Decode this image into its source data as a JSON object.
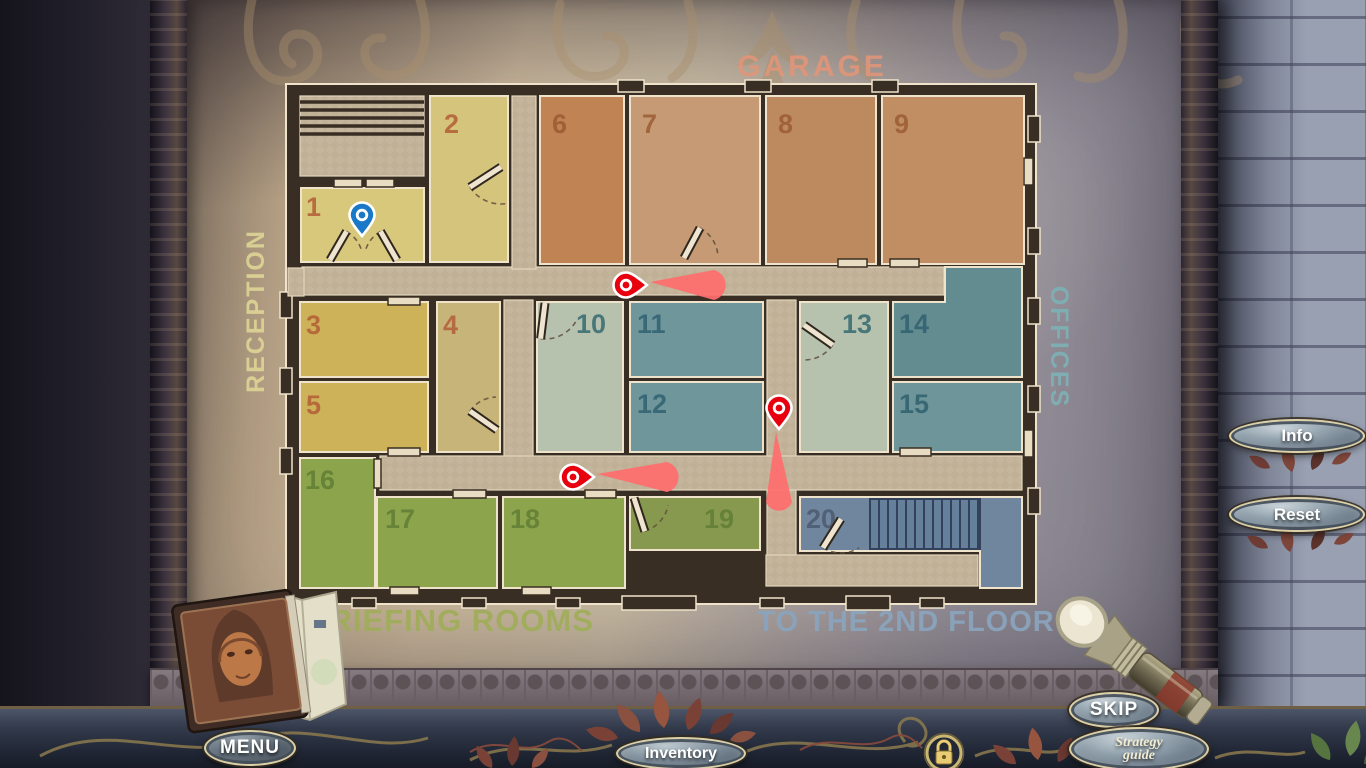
{
  "hud": {
    "info": "Info",
    "reset": "Reset",
    "skip": "SKIP",
    "strategy_line1": "Strategy",
    "strategy_line2": "guide",
    "menu": "MENU",
    "inventory": "Inventory"
  },
  "map": {
    "palette": {
      "wall": "#382e23",
      "outline": "#efe3cb",
      "corridor": "#c4b59c",
      "corridor_check": "#bbab92",
      "beam": "#ff6e6e",
      "pin_red": "#e8000f",
      "pin_blue": "#1a78c8",
      "stair_fill": "#64809b",
      "stair_line": "#33415a"
    },
    "building": {
      "x": 286,
      "y": 84,
      "w": 750,
      "h": 520
    },
    "labels": [
      {
        "id": "garage",
        "text": "GARAGE",
        "x": 812,
        "y": 76,
        "rot": 0,
        "size": 30,
        "color": "#e09579",
        "spacing": 3
      },
      {
        "id": "reception",
        "text": "RECEPTION",
        "x": 264,
        "y": 311,
        "rot": -90,
        "size": 25,
        "color": "#ddd494",
        "spacing": 2
      },
      {
        "id": "offices",
        "text": "OFFICES",
        "x": 1051,
        "y": 347,
        "rot": 90,
        "size": 25,
        "color": "#7db1b5",
        "spacing": 2
      },
      {
        "id": "briefing-rooms",
        "text": "BRIEFING ROOMS",
        "x": 450,
        "y": 631,
        "rot": 0,
        "size": 31,
        "color": "#9fae59",
        "spacing": 1
      },
      {
        "id": "to-the-2nd-floor",
        "text": "TO THE 2ND FLOOR",
        "x": 906,
        "y": 631,
        "rot": 0,
        "size": 29,
        "color": "#8aa5be",
        "spacing": 1
      }
    ],
    "rooms": [
      {
        "n": "1",
        "x": 301,
        "y": 188,
        "w": 123,
        "h": 74,
        "fill": "#d8c87c",
        "nc": "#b25a33",
        "nx": 306,
        "ny": 216
      },
      {
        "n": "2",
        "x": 430,
        "y": 96,
        "w": 78,
        "h": 166,
        "fill": "#d5c57c",
        "nc": "#b25a33",
        "nx": 444,
        "ny": 133
      },
      {
        "n": "3",
        "x": 300,
        "y": 302,
        "w": 128,
        "h": 75,
        "fill": "#cdb259",
        "nc": "#b25a33",
        "nx": 306,
        "ny": 334
      },
      {
        "n": "4",
        "x": 437,
        "y": 302,
        "w": 63,
        "h": 150,
        "fill": "#c7b478",
        "nc": "#b25a33",
        "nx": 443,
        "ny": 334
      },
      {
        "n": "5",
        "x": 300,
        "y": 382,
        "w": 128,
        "h": 70,
        "fill": "#cdb259",
        "nc": "#b25a33",
        "nx": 306,
        "ny": 414
      },
      {
        "n": "6",
        "x": 540,
        "y": 96,
        "w": 84,
        "h": 168,
        "fill": "#bf8354",
        "nc": "#9a5a31",
        "nx": 552,
        "ny": 133
      },
      {
        "n": "7",
        "x": 630,
        "y": 96,
        "w": 130,
        "h": 168,
        "fill": "#c69a74",
        "nc": "#9a5a31",
        "nx": 642,
        "ny": 133
      },
      {
        "n": "8",
        "x": 766,
        "y": 96,
        "w": 110,
        "h": 168,
        "fill": "#bd895f",
        "nc": "#9a5a31",
        "nx": 778,
        "ny": 133
      },
      {
        "n": "9",
        "x": 882,
        "y": 96,
        "w": 142,
        "h": 168,
        "fill": "#c18e64",
        "nc": "#9a5a31",
        "nx": 894,
        "ny": 133
      },
      {
        "n": "10",
        "x": 537,
        "y": 302,
        "w": 86,
        "h": 150,
        "fill": "#b6c2ae",
        "nc": "#31676f",
        "nx": 576,
        "ny": 333
      },
      {
        "n": "11",
        "x": 630,
        "y": 302,
        "w": 133,
        "h": 75,
        "fill": "#6f979b",
        "nc": "#2e5f6e",
        "nx": 637,
        "ny": 333
      },
      {
        "n": "12",
        "x": 630,
        "y": 382,
        "w": 133,
        "h": 70,
        "fill": "#6f979b",
        "nc": "#2e5f6e",
        "nx": 637,
        "ny": 413
      },
      {
        "n": "13",
        "x": 800,
        "y": 302,
        "w": 88,
        "h": 150,
        "fill": "#b6c2ae",
        "nc": "#31676f",
        "nx": 842,
        "ny": 333
      },
      {
        "n": "14",
        "poly": "945,267 1022,267 1022,377 893,377 893,302 945,302",
        "fill": "#638c91",
        "nc": "#2e5f6e",
        "nx": 899,
        "ny": 333
      },
      {
        "n": "15",
        "x": 893,
        "y": 382,
        "w": 129,
        "h": 70,
        "fill": "#6e969a",
        "nc": "#2e5f6e",
        "nx": 899,
        "ny": 413
      },
      {
        "n": "16",
        "x": 300,
        "y": 458,
        "w": 75,
        "h": 130,
        "fill": "#8ca44c",
        "nc": "#5f7c34",
        "nx": 305,
        "ny": 489
      },
      {
        "n": "17",
        "x": 377,
        "y": 497,
        "w": 120,
        "h": 91,
        "fill": "#8ca44c",
        "nc": "#5f7c34",
        "nx": 385,
        "ny": 528
      },
      {
        "n": "18",
        "x": 503,
        "y": 497,
        "w": 122,
        "h": 91,
        "fill": "#8ca44c",
        "nc": "#5f7c34",
        "nx": 510,
        "ny": 528
      },
      {
        "n": "19",
        "x": 630,
        "y": 497,
        "w": 130,
        "h": 53,
        "fill": "#87994e",
        "nc": "#5f7c34",
        "nx": 704,
        "ny": 528
      },
      {
        "n": "20",
        "poly": "800,497 1022,497 1022,588 980,588 980,551 800,551",
        "fill": "#70869f",
        "nc": "#49586d",
        "nx": 806,
        "ny": 528
      }
    ],
    "corridors": [
      {
        "x": 302,
        "y": 267,
        "w": 642,
        "h": 28
      },
      {
        "x": 512,
        "y": 96,
        "w": 24,
        "h": 173
      },
      {
        "x": 504,
        "y": 300,
        "w": 29,
        "h": 158
      },
      {
        "x": 767,
        "y": 300,
        "w": 29,
        "h": 257
      },
      {
        "x": 380,
        "y": 456,
        "w": 642,
        "h": 34
      },
      {
        "x": 766,
        "y": 555,
        "w": 212,
        "h": 31
      },
      {
        "x": 288,
        "y": 268,
        "w": 16,
        "h": 28
      }
    ],
    "stairs_entry": {
      "x": 300,
      "y": 96,
      "w": 124,
      "h": 80,
      "steps": 5
    },
    "stairs_upper": {
      "x": 870,
      "y": 499,
      "w": 110,
      "h": 50,
      "step": 9
    },
    "windows": [
      {
        "x": 334,
        "y": 179,
        "w": 28,
        "h": 8
      },
      {
        "x": 366,
        "y": 179,
        "w": 28,
        "h": 8
      },
      {
        "x": 388,
        "y": 297,
        "w": 32,
        "h": 8
      },
      {
        "x": 388,
        "y": 448,
        "w": 32,
        "h": 8
      },
      {
        "x": 453,
        "y": 490,
        "w": 33,
        "h": 8
      },
      {
        "x": 585,
        "y": 490,
        "w": 31,
        "h": 8
      },
      {
        "x": 838,
        "y": 259,
        "w": 29,
        "h": 8
      },
      {
        "x": 890,
        "y": 259,
        "w": 29,
        "h": 8
      },
      {
        "x": 900,
        "y": 448,
        "w": 31,
        "h": 8
      },
      {
        "x": 374,
        "y": 459,
        "w": 7,
        "h": 29
      },
      {
        "x": 1024,
        "y": 158,
        "w": 9,
        "h": 27
      },
      {
        "x": 1024,
        "y": 430,
        "w": 9,
        "h": 27
      },
      {
        "x": 390,
        "y": 587,
        "w": 29,
        "h": 8
      },
      {
        "x": 522,
        "y": 587,
        "w": 29,
        "h": 8
      }
    ],
    "pilasters": [
      {
        "x": 618,
        "y": 80,
        "w": 26,
        "h": 12
      },
      {
        "x": 745,
        "y": 80,
        "w": 26,
        "h": 12
      },
      {
        "x": 872,
        "y": 80,
        "w": 26,
        "h": 12
      },
      {
        "x": 1028,
        "y": 116,
        "w": 12,
        "h": 26
      },
      {
        "x": 1028,
        "y": 228,
        "w": 12,
        "h": 26
      },
      {
        "x": 1028,
        "y": 298,
        "w": 12,
        "h": 26
      },
      {
        "x": 1028,
        "y": 386,
        "w": 12,
        "h": 26
      },
      {
        "x": 1028,
        "y": 488,
        "w": 12,
        "h": 26
      },
      {
        "x": 280,
        "y": 292,
        "w": 12,
        "h": 26
      },
      {
        "x": 280,
        "y": 368,
        "w": 12,
        "h": 26
      },
      {
        "x": 280,
        "y": 448,
        "w": 12,
        "h": 26
      },
      {
        "x": 622,
        "y": 596,
        "w": 74,
        "h": 14
      },
      {
        "x": 846,
        "y": 596,
        "w": 44,
        "h": 14
      },
      {
        "x": 352,
        "y": 598,
        "w": 24,
        "h": 10
      },
      {
        "x": 462,
        "y": 598,
        "w": 24,
        "h": 10
      },
      {
        "x": 556,
        "y": 598,
        "w": 24,
        "h": 10
      },
      {
        "x": 760,
        "y": 598,
        "w": 24,
        "h": 10
      },
      {
        "x": 920,
        "y": 598,
        "w": 24,
        "h": 10
      }
    ],
    "doors": [
      {
        "hx": 501,
        "hy": 167,
        "len": 37,
        "leaf": 147,
        "arc": 83
      },
      {
        "hx": 330,
        "hy": 260,
        "len": 33,
        "leaf": -60,
        "arc": -18
      },
      {
        "hx": 397,
        "hy": 260,
        "len": 33,
        "leaf": -120,
        "arc": -162
      },
      {
        "hx": 684,
        "hy": 258,
        "len": 34,
        "leaf": -62,
        "arc": -2
      },
      {
        "hx": 497,
        "hy": 430,
        "len": 33,
        "leaf": -145,
        "arc": -92
      },
      {
        "hx": 545,
        "hy": 303,
        "len": 36,
        "leaf": 97,
        "arc": 30
      },
      {
        "hx": 804,
        "hy": 325,
        "len": 35,
        "leaf": 35,
        "arc": 88
      },
      {
        "hx": 634,
        "hy": 498,
        "len": 35,
        "leaf": 72,
        "arc": 12
      },
      {
        "hx": 841,
        "hy": 519,
        "len": 34,
        "leaf": 122,
        "arc": 58
      }
    ],
    "pins": [
      {
        "id": "player-location",
        "color": "#1a78c8",
        "x": 362,
        "y": 219,
        "dir": "down"
      },
      {
        "id": "task-pin-top",
        "color": "#e8000f",
        "x": 630,
        "y": 285,
        "dir": "right",
        "beam": 64
      },
      {
        "id": "task-pin-right",
        "color": "#e8000f",
        "x": 779,
        "y": 412,
        "dir": "down",
        "beam": 70
      },
      {
        "id": "task-pin-bottom",
        "color": "#e8000f",
        "x": 577,
        "y": 477,
        "dir": "right",
        "beam": 70
      }
    ]
  }
}
